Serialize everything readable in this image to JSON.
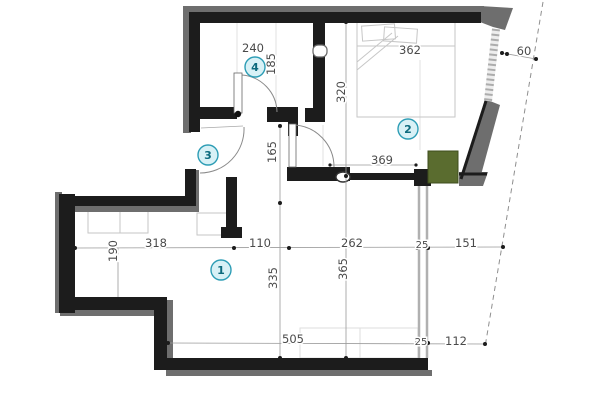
{
  "title": "Apartment floor plan",
  "colors": {
    "wall": "#1c1c1c",
    "wall_shadow": "#6e6e6e",
    "shaft_green": "#5a6c2f",
    "shaft_green_border": "#3e4d1e",
    "badge_fill": "#d8f1f6",
    "badge_stroke": "#2d9db5",
    "badge_text": "#0d6a7d",
    "dim_text": "#4a4a4a",
    "dim_line": "#9a9a9a",
    "boundary_dashed": "#8f8f8f"
  },
  "rooms": [
    {
      "number": "1",
      "x": 221,
      "y": 270
    },
    {
      "number": "2",
      "x": 408,
      "y": 129
    },
    {
      "number": "3",
      "x": 208,
      "y": 155
    },
    {
      "number": "4",
      "x": 255,
      "y": 67
    }
  ],
  "dimensions_cm": [
    {
      "label": "240",
      "x": 253,
      "y": 48,
      "rotate": 0,
      "size": "normal"
    },
    {
      "label": "185",
      "x": 271,
      "y": 64,
      "rotate": -90,
      "size": "normal"
    },
    {
      "label": "362",
      "x": 410,
      "y": 50,
      "rotate": 0,
      "size": "normal"
    },
    {
      "label": "60",
      "x": 524,
      "y": 51,
      "rotate": 0,
      "size": "normal"
    },
    {
      "label": "320",
      "x": 341,
      "y": 92,
      "rotate": -90,
      "size": "normal"
    },
    {
      "label": "165",
      "x": 272,
      "y": 152,
      "rotate": -90,
      "size": "normal"
    },
    {
      "label": "369",
      "x": 382,
      "y": 160,
      "rotate": 0,
      "size": "normal"
    },
    {
      "label": "318",
      "x": 156,
      "y": 243,
      "rotate": 0,
      "size": "normal"
    },
    {
      "label": "110",
      "x": 260,
      "y": 243,
      "rotate": 0,
      "size": "normal"
    },
    {
      "label": "262",
      "x": 352,
      "y": 243,
      "rotate": 0,
      "size": "normal"
    },
    {
      "label": "25",
      "x": 422,
      "y": 244,
      "rotate": 0,
      "size": "small"
    },
    {
      "label": "151",
      "x": 466,
      "y": 243,
      "rotate": 0,
      "size": "normal"
    },
    {
      "label": "190",
      "x": 113,
      "y": 251,
      "rotate": -90,
      "size": "normal"
    },
    {
      "label": "335",
      "x": 273,
      "y": 278,
      "rotate": -90,
      "size": "normal"
    },
    {
      "label": "365",
      "x": 343,
      "y": 269,
      "rotate": -90,
      "size": "normal"
    },
    {
      "label": "505",
      "x": 293,
      "y": 339,
      "rotate": 0,
      "size": "normal"
    },
    {
      "label": "25",
      "x": 421,
      "y": 341,
      "rotate": 0,
      "size": "small"
    },
    {
      "label": "112",
      "x": 456,
      "y": 341,
      "rotate": 0,
      "size": "normal"
    }
  ]
}
